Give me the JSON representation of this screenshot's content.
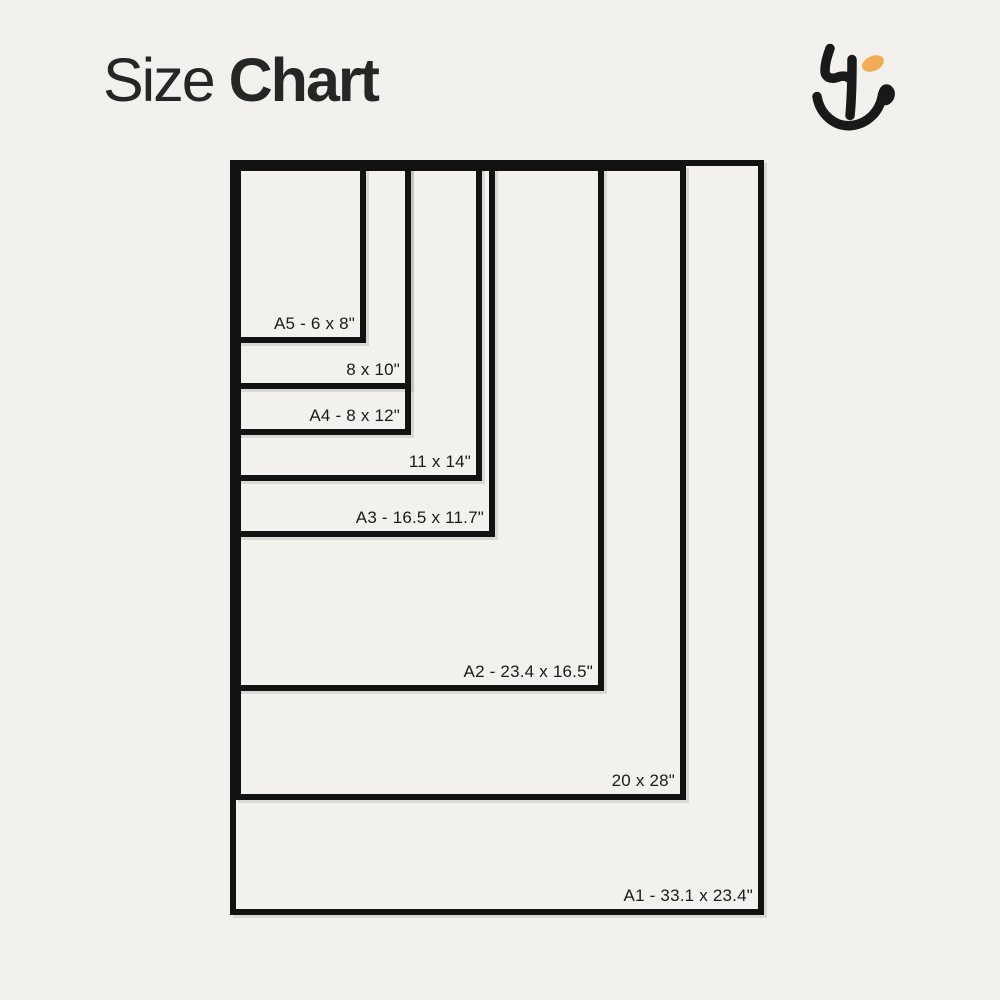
{
  "page": {
    "background": "#F2F1ED",
    "width": 1000,
    "height": 1000
  },
  "header": {
    "title_regular": "Size",
    "title_bold": "Chart",
    "title_color": "#262626"
  },
  "logo": {
    "name": "brand-monogram",
    "stroke_color": "#191919",
    "accent_color": "#F0AD55"
  },
  "chart_data": {
    "type": "nested-rectangles",
    "title": "Size Chart",
    "unit": "inches",
    "line_color": "#121212",
    "label_color": "#1A1A1A",
    "sizes": [
      {
        "id": "a1",
        "label": "A1 - 33.1 x 23.4\"",
        "width_in": 23.4,
        "height_in": 33.1,
        "box": {
          "left": 230,
          "top": 160,
          "width": 534,
          "height": 755
        }
      },
      {
        "id": "20x28",
        "label": "20 x 28\"",
        "width_in": 20,
        "height_in": 28,
        "box": {
          "left": 235,
          "top": 165,
          "width": 451,
          "height": 635
        }
      },
      {
        "id": "a2",
        "label": "A2 - 23.4 x 16.5\"",
        "width_in": 16.5,
        "height_in": 23.4,
        "box": {
          "left": 235,
          "top": 165,
          "width": 369,
          "height": 526
        }
      },
      {
        "id": "a3",
        "label": "A3 - 16.5 x 11.7\"",
        "width_in": 11.7,
        "height_in": 16.5,
        "box": {
          "left": 235,
          "top": 165,
          "width": 260,
          "height": 372
        }
      },
      {
        "id": "11x14",
        "label": "11 x 14\"",
        "width_in": 11,
        "height_in": 14,
        "box": {
          "left": 235,
          "top": 165,
          "width": 247,
          "height": 316
        }
      },
      {
        "id": "a4",
        "label": "A4 - 8 x 12\"",
        "width_in": 8,
        "height_in": 12,
        "box": {
          "left": 235,
          "top": 165,
          "width": 176,
          "height": 270
        }
      },
      {
        "id": "8x10",
        "label": "8 x 10\"",
        "width_in": 8,
        "height_in": 10,
        "box": {
          "left": 235,
          "top": 165,
          "width": 176,
          "height": 224
        }
      },
      {
        "id": "a5",
        "label": "A5 - 6 x 8\"",
        "width_in": 6,
        "height_in": 8,
        "box": {
          "left": 235,
          "top": 165,
          "width": 131,
          "height": 178
        }
      }
    ]
  }
}
